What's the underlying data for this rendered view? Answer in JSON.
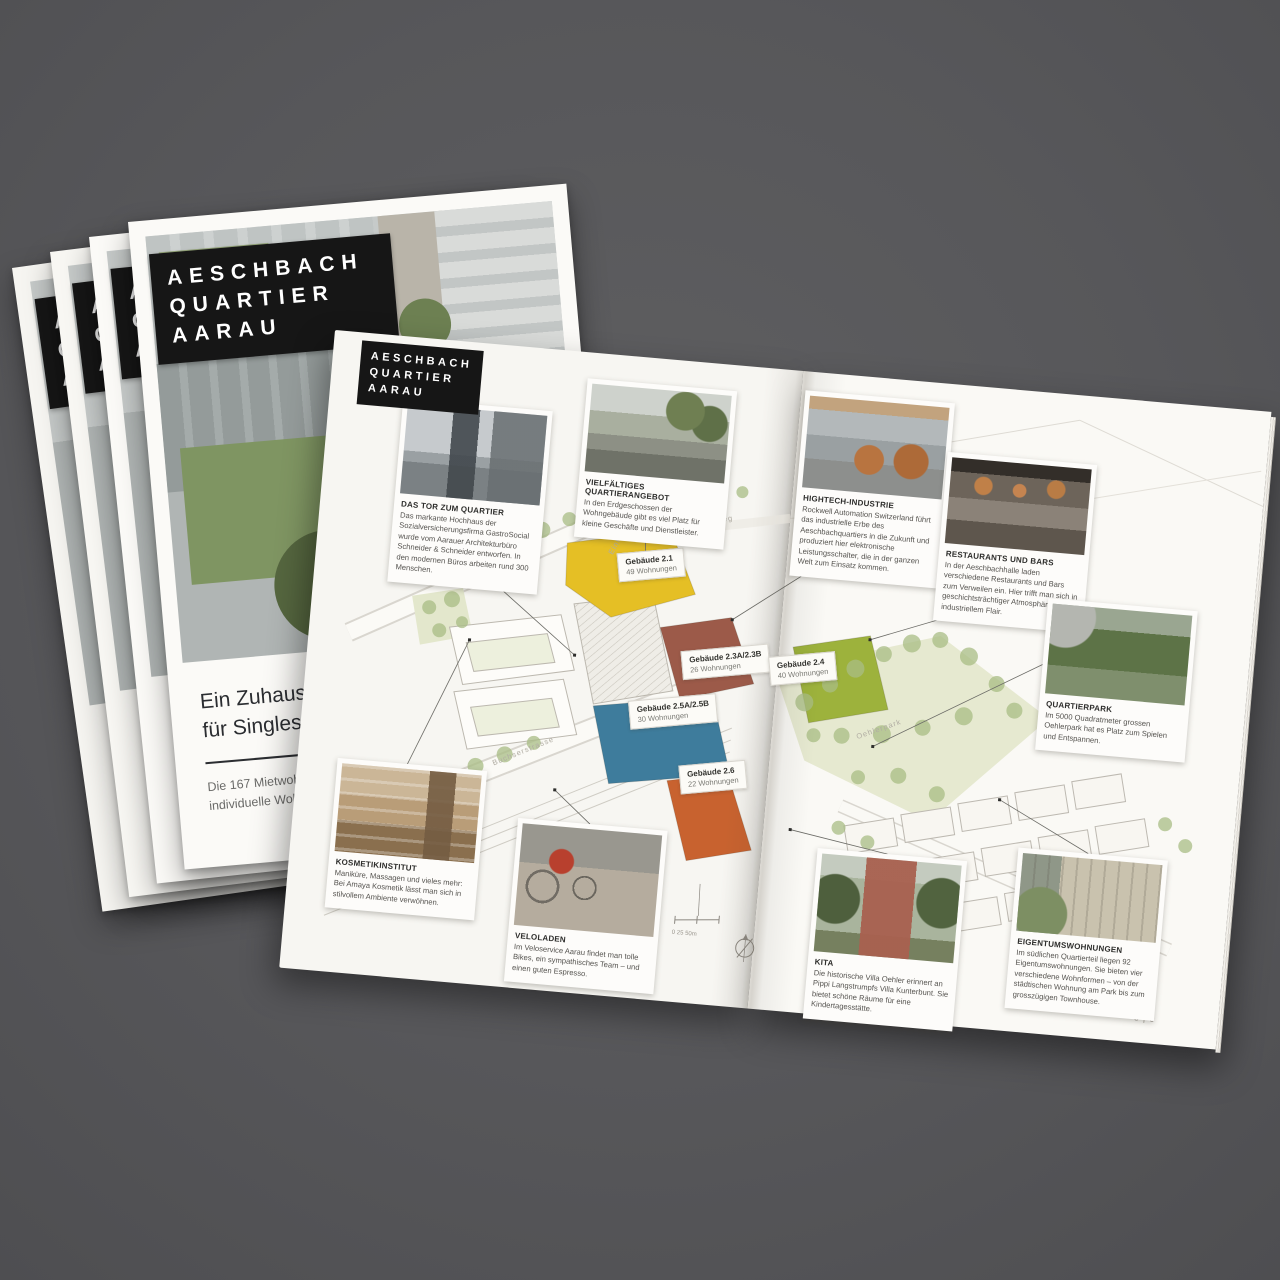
{
  "scene": {
    "background": "#59595b",
    "brand_black": "#161616",
    "paper_white": "#f8f7f3"
  },
  "cover": {
    "logo": {
      "line1": "AESCHBACH",
      "line2": "QUARTIER",
      "line3": "AARAU"
    },
    "headline_line1": "Ein Zuhause mit urb",
    "headline_line2": "für Singles, Paare,",
    "subline1": "Die 167 Mietwohnungen im",
    "subline2": "individuelle Wohnträume –"
  },
  "spread": {
    "logo": {
      "line1": "AESCHBACH",
      "line2": "QUARTIER",
      "line3": "AARAU"
    },
    "page_number": "8 | 9",
    "scale_label": "0 25 50m",
    "park_color": "#e3e7cc",
    "cards": [
      {
        "title": "DAS TOR ZUM QUARTIER",
        "body": "Das markante Hochhaus der Sozialversicherungsfirma GastroSocial wurde vom Aarauer Architekturbüro Schneider & Schneider entworfen. In den modernen Büros arbeiten rund 300 Menschen."
      },
      {
        "title": "VIELFÄLTIGES QUARTIERANGEBOT",
        "body": "In den Erdgeschossen der Wohngebäude gibt es viel Platz für kleine Geschäfte und Dienstleister."
      },
      {
        "title": "HIGHTECH-INDUSTRIE",
        "body": "Rockwell Automation Switzerland führt das industrielle Erbe des Aeschbachquartiers in die Zukunft und produziert hier elektronische Leistungsschalter, die in der ganzen Welt zum Einsatz kommen."
      },
      {
        "title": "RESTAURANTS UND BARS",
        "body": "In der Aeschbachhalle laden verschiedene Restaurants und Bars zum Verweilen ein. Hier trifft man sich in geschichtsträchtiger Atmosphäre mit industriellem Flair."
      },
      {
        "title": "QUARTIERPARK",
        "body": "Im 5000 Quadratmeter grossen Oehlerpark hat es Platz zum Spielen und Entspannen."
      },
      {
        "title": "KOSMETIKINSTITUT",
        "body": "Maniküre, Massagen und vieles mehr: Bei Amaya Kosmetik lässt man sich in stilvollem Ambiente verwöhnen."
      },
      {
        "title": "VELOLADEN",
        "body": "Im Veloservice Aarau findet man tolle Bikes, ein sympathisches Team – und einen guten Espresso."
      },
      {
        "title": "KITA",
        "body": "Die historische Villa Oehler erinnert an Pippi Langstrumpfs Villa Kunterbunt. Sie bietet schöne Räume für eine Kindertagesstätte."
      },
      {
        "title": "EIGENTUMSWOHNUNGEN",
        "body": "Im südlichen Quartierteil liegen 92 Eigentumswohnungen. Sie bieten vier verschiedene Wohnformen – von der städtischen Wohnung am Park bis zum grosszügigen Townhouse."
      }
    ],
    "buildings": [
      {
        "name": "Gebäude 2.1",
        "units": "49 Wohnungen",
        "color": "#e5bf25"
      },
      {
        "name": "Gebäude 2.3A/2.3B",
        "units": "26 Wohnungen",
        "color": "#9c5a49"
      },
      {
        "name": "Gebäude 2.4",
        "units": "40 Wohnungen",
        "color": "#9db23c"
      },
      {
        "name": "Gebäude 2.5A/2.5B",
        "units": "30 Wohnungen",
        "color": "#3e7c9c"
      },
      {
        "name": "Gebäude 2.6",
        "units": "22 Wohnungen",
        "color": "#c8622f"
      }
    ],
    "streets": [
      "Hubelmattstrasse",
      "Buchserstrasse",
      "Einfahrt Tiefgarage",
      "Aeschbachweg",
      "Oehlerpark"
    ]
  }
}
